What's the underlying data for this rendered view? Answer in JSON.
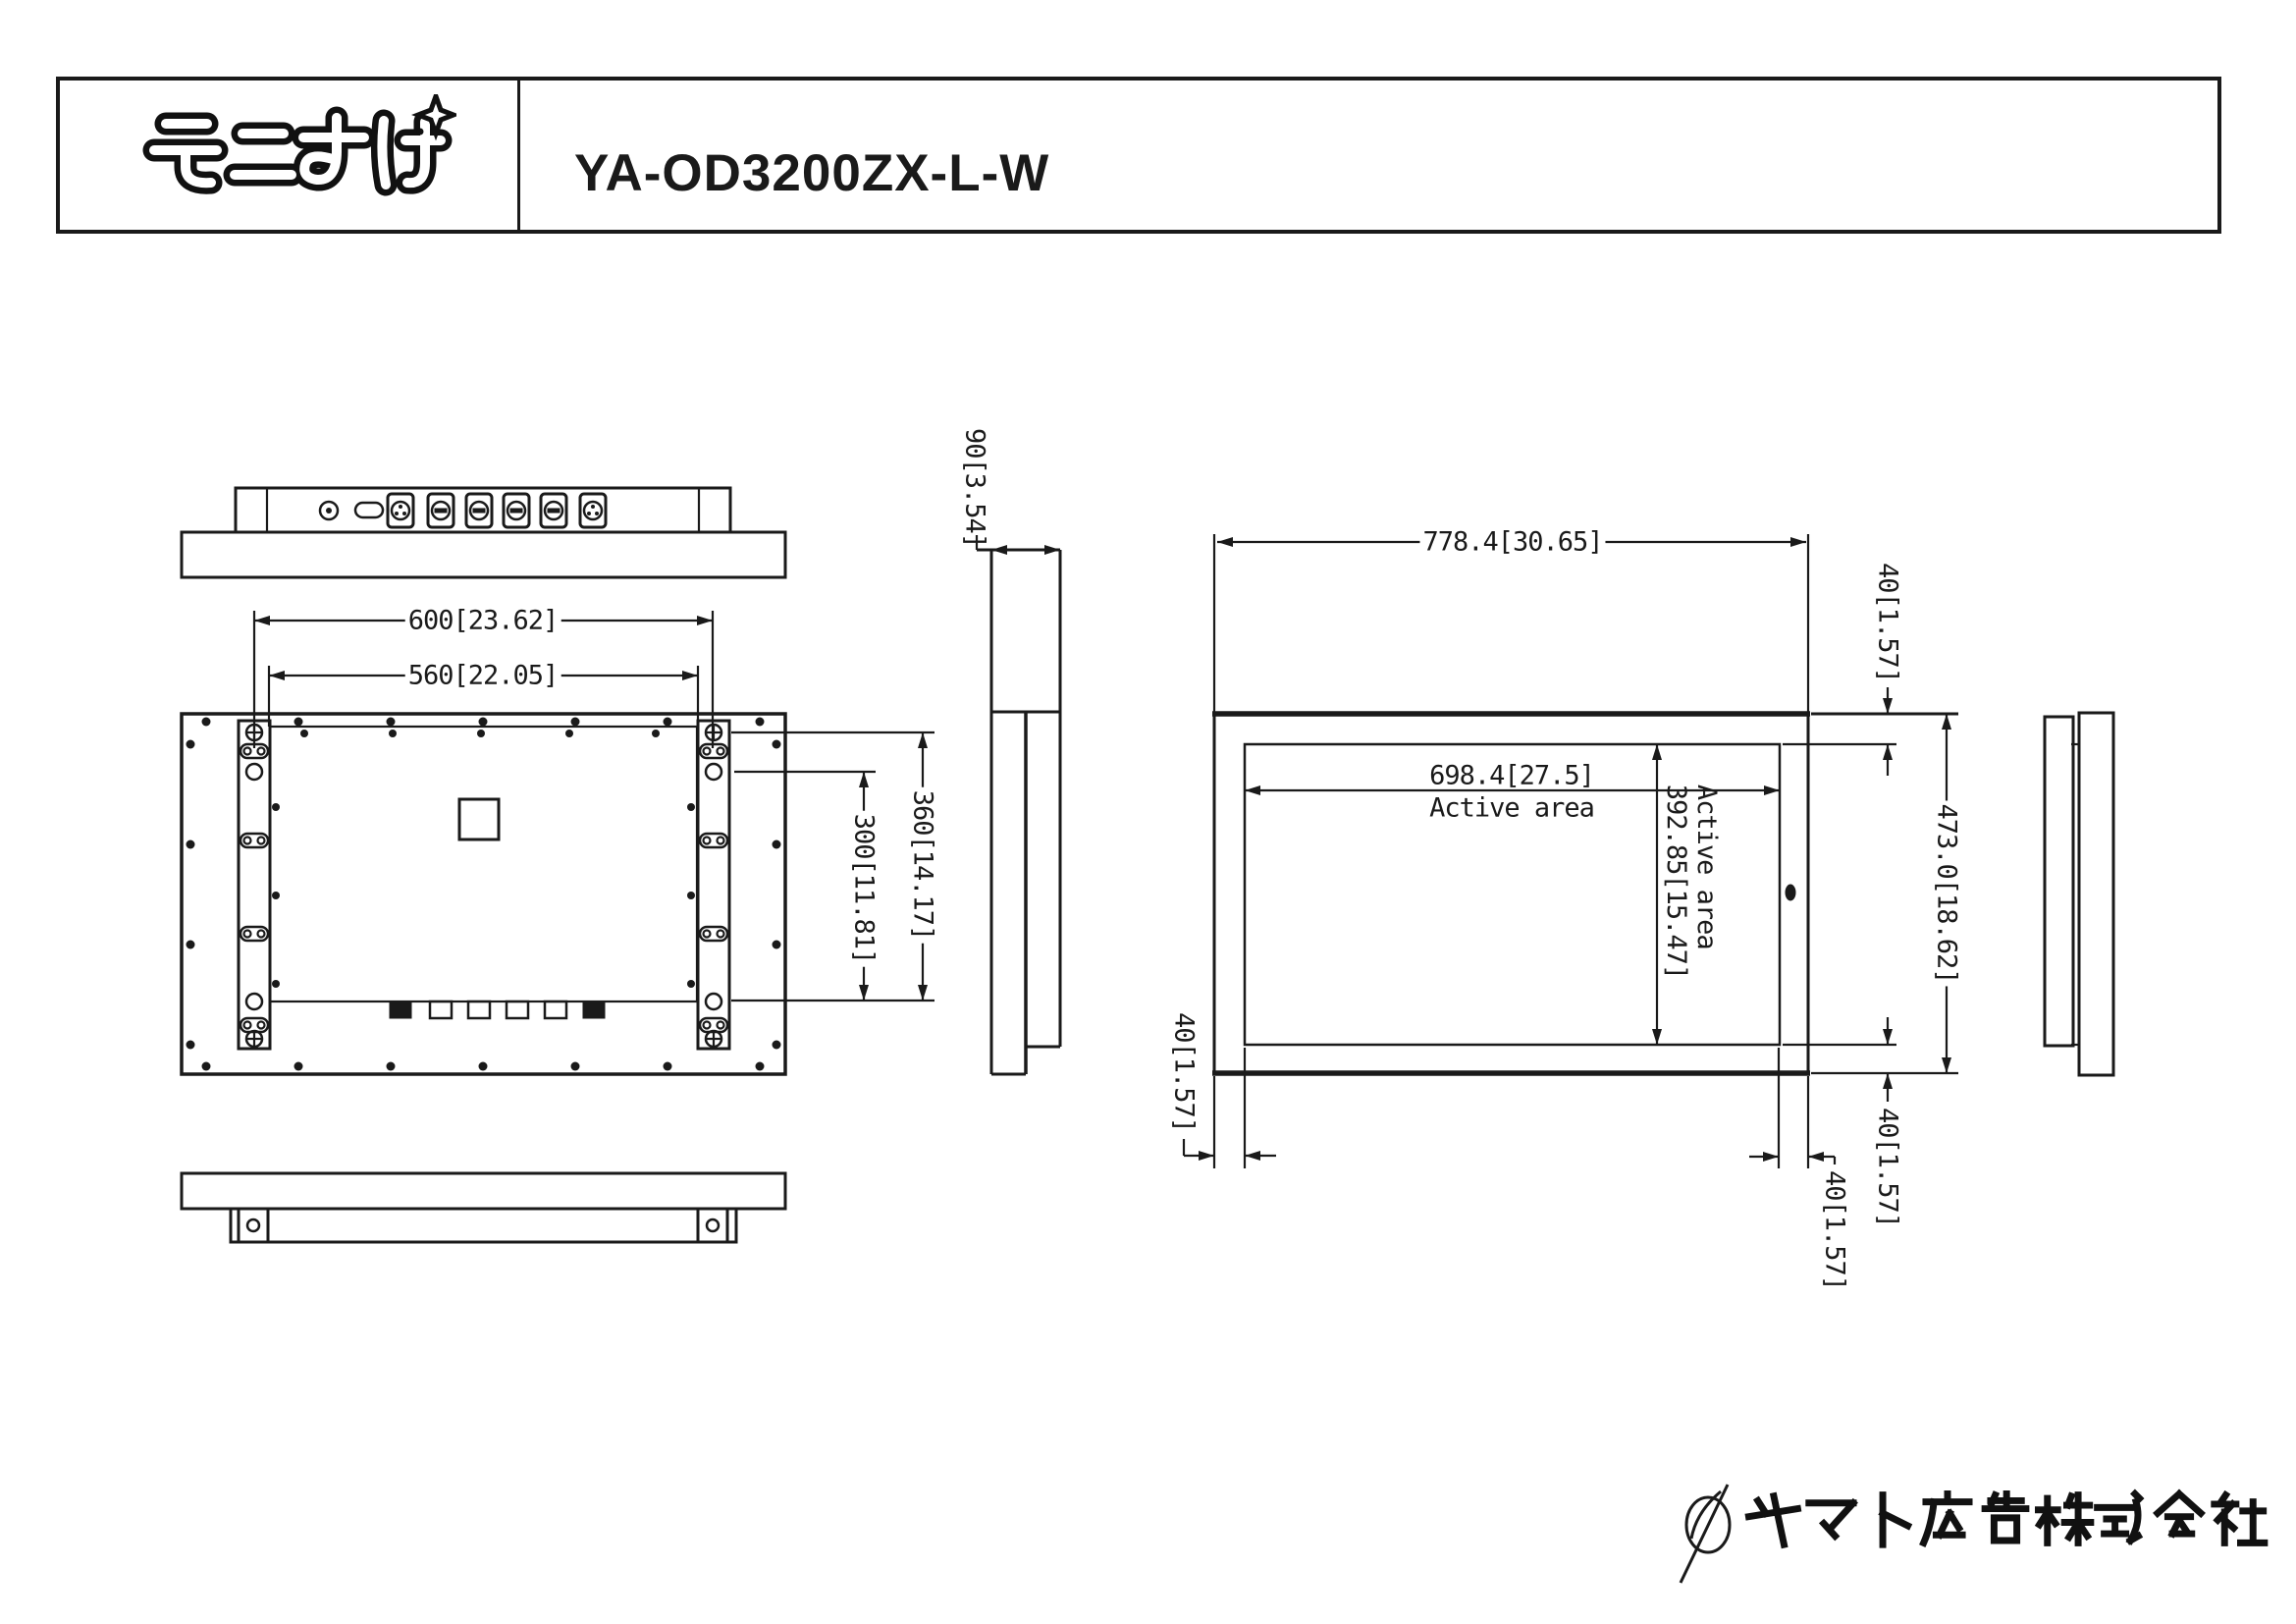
{
  "colors": {
    "line": "#1a1a1a",
    "background": "#ffffff"
  },
  "header": {
    "logo_text": "モニすけ",
    "model": "YA-OD3200ZX-L-W"
  },
  "views": {
    "top": {
      "dim_width_outer": "600[23.62]",
      "dim_width_inner": "560[22.05]"
    },
    "side": {
      "dim_depth": "90[3.54]"
    },
    "rear": {
      "dim_hole_span_outer": "360[14.17]",
      "dim_hole_span_inner": "300[11.81]"
    },
    "front": {
      "dim_width": "778.4[30.65]",
      "dim_active_width": "698.4[27.5]",
      "active_width_label": "Active area",
      "dim_active_height": "392.85[15.47]",
      "active_height_label": "Active area",
      "dim_height": "473.0[18.62]",
      "dim_bezel_top": "40[1.57]",
      "dim_bezel_bottom": "40[1.57]",
      "dim_bezel_right": "40[1.57]",
      "dim_bezel_left": "40[1.57]"
    }
  },
  "footer": {
    "company": "ヤマト広告株式会社"
  }
}
